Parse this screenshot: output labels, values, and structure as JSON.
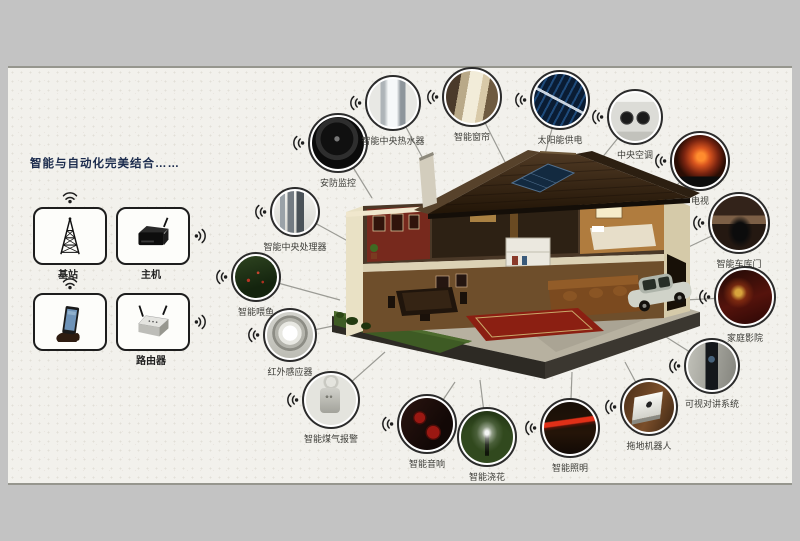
{
  "title": "智能与自动化完美结合……",
  "left_panel": {
    "devices": [
      {
        "label": "基站",
        "icon": "radio-tower"
      },
      {
        "label": "主机",
        "icon": "set-top-box"
      },
      {
        "label": "",
        "icon": "smartphone"
      },
      {
        "label": "路由器",
        "icon": "router"
      }
    ]
  },
  "nodes": [
    {
      "label": "安防监控",
      "icon": "security-camera",
      "x": 338,
      "y": 143,
      "r": 30,
      "tx": 372,
      "ty": 198
    },
    {
      "label": "智能中央热水器",
      "icon": "water-heater",
      "x": 393,
      "y": 103,
      "r": 28,
      "tx": 428,
      "ty": 168
    },
    {
      "label": "智能窗帘",
      "icon": "curtain",
      "x": 472,
      "y": 97,
      "r": 30,
      "tx": 505,
      "ty": 162
    },
    {
      "label": "太阳能供电",
      "icon": "solar-power",
      "x": 560,
      "y": 100,
      "r": 30,
      "tx": 540,
      "ty": 172
    },
    {
      "label": "中央空调",
      "icon": "air-conditioner",
      "x": 635,
      "y": 117,
      "r": 28,
      "tx": 580,
      "ty": 185
    },
    {
      "label": "电视",
      "icon": "tv",
      "x": 700,
      "y": 161,
      "r": 30,
      "tx": 655,
      "ty": 208
    },
    {
      "label": "智能车库门",
      "icon": "garage-door",
      "x": 739,
      "y": 223,
      "r": 31,
      "tx": 678,
      "ty": 252
    },
    {
      "label": "家庭影院",
      "icon": "home-theater",
      "x": 745,
      "y": 297,
      "r": 31,
      "tx": 684,
      "ty": 300
    },
    {
      "label": "可视对讲系统",
      "icon": "video-intercom",
      "x": 712,
      "y": 366,
      "r": 28,
      "tx": 655,
      "ty": 330
    },
    {
      "label": "拖地机器人",
      "icon": "mopping-robot",
      "x": 649,
      "y": 407,
      "r": 29,
      "tx": 625,
      "ty": 362
    },
    {
      "label": "智能照明",
      "icon": "smart-lighting",
      "x": 570,
      "y": 428,
      "r": 30,
      "tx": 572,
      "ty": 372
    },
    {
      "label": "智能浇花",
      "icon": "sprinkler",
      "x": 487,
      "y": 437,
      "r": 30,
      "tx": 480,
      "ty": 380
    },
    {
      "label": "智能音响",
      "icon": "speakers",
      "x": 427,
      "y": 424,
      "r": 30,
      "tx": 455,
      "ty": 382
    },
    {
      "label": "智能煤气报警",
      "icon": "gas-alarm",
      "x": 331,
      "y": 400,
      "r": 29,
      "tx": 385,
      "ty": 352
    },
    {
      "label": "红外感应器",
      "icon": "infrared-sensor",
      "x": 290,
      "y": 335,
      "r": 27,
      "tx": 352,
      "ty": 322
    },
    {
      "label": "智能喂鱼",
      "icon": "fish-feeder",
      "x": 256,
      "y": 277,
      "r": 25,
      "tx": 340,
      "ty": 300
    },
    {
      "label": "智能中央处理器",
      "icon": "central-processor",
      "x": 295,
      "y": 212,
      "r": 25,
      "tx": 355,
      "ty": 245
    }
  ],
  "colors": {
    "background": "#c3c3c3",
    "poster": "#f2f1ec",
    "title": "#1b2b4d",
    "line": "#9b9b95"
  }
}
